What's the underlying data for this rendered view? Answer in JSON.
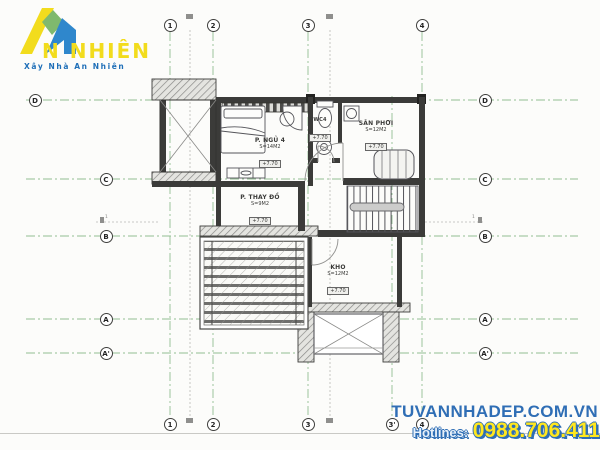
{
  "logo": {
    "brand": "N NHIÊN",
    "tagline": "Xây Nhà An Nhiên",
    "colors": {
      "yellow": "#f2dc1d",
      "green": "#7fb96e",
      "blue": "#2f87cc"
    }
  },
  "watermark": {
    "site": "TUVANNHADEP.COM.VN",
    "hotline_label": "Hotlines:",
    "hotline_number": "0988.706.411",
    "site_color": "#2f6eb5",
    "number_color": "#ffe71e"
  },
  "grid": {
    "cols_top": [
      "1",
      "2",
      "3",
      "4"
    ],
    "cols_bottom": [
      "1",
      "2",
      "3",
      "3'",
      "4"
    ],
    "rows_left": [
      "D",
      "C",
      "B",
      "A",
      "A'"
    ],
    "rows_right": [
      "D",
      "C",
      "B",
      "A",
      "A'"
    ],
    "section_mark": "1",
    "line_color": "#92be92"
  },
  "rooms": {
    "ngu4": {
      "name": "P. NGỦ 4",
      "area": "S=14M2",
      "level": "+7.70"
    },
    "wc4": {
      "name": "WC4",
      "level": "+7.70"
    },
    "sanphoi": {
      "name": "SÂN PHƠI",
      "area": "S=12M2",
      "level": "+7.70"
    },
    "thaydo": {
      "name": "P. THAY ĐỒ",
      "area": "S=9M2",
      "level": "+7.70"
    },
    "kho": {
      "name": "KHO",
      "area": "S=12M2",
      "level": "+7.70"
    }
  }
}
